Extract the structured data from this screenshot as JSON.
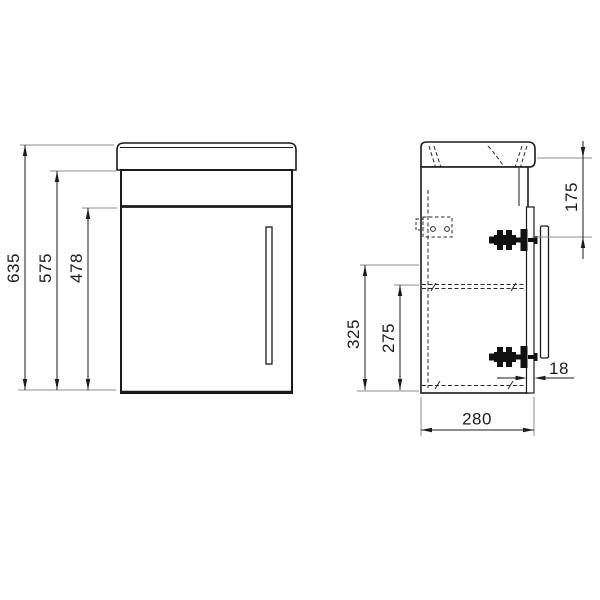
{
  "canvas": {
    "width": 600,
    "height": 600,
    "background": "#ffffff"
  },
  "colors": {
    "outline": "#1b1b1b",
    "dimension_line": "#1b1b1b",
    "extension_line": "#8c8c8c",
    "hidden_line": "#2a2a2a",
    "hardware": "#111111"
  },
  "views": {
    "front": {
      "id": "front-view",
      "parts": [
        "basin",
        "apron",
        "door",
        "door-handle"
      ]
    },
    "side": {
      "id": "side-view",
      "parts": [
        "basin",
        "carcass",
        "door",
        "door-handle",
        "top-hinge",
        "bottom-hinge",
        "wall-bracket",
        "shelf",
        "drain"
      ]
    }
  },
  "dimensions": {
    "front": [
      {
        "id": "overall-height",
        "value": "635"
      },
      {
        "id": "cabinet-height",
        "value": "575"
      },
      {
        "id": "door-height",
        "value": "478"
      }
    ],
    "side": [
      {
        "id": "top-to-hinge",
        "value": "175"
      },
      {
        "id": "height-325",
        "value": "325"
      },
      {
        "id": "height-275",
        "value": "275"
      },
      {
        "id": "door-thickness",
        "value": "18"
      },
      {
        "id": "depth",
        "value": "280"
      }
    ]
  }
}
